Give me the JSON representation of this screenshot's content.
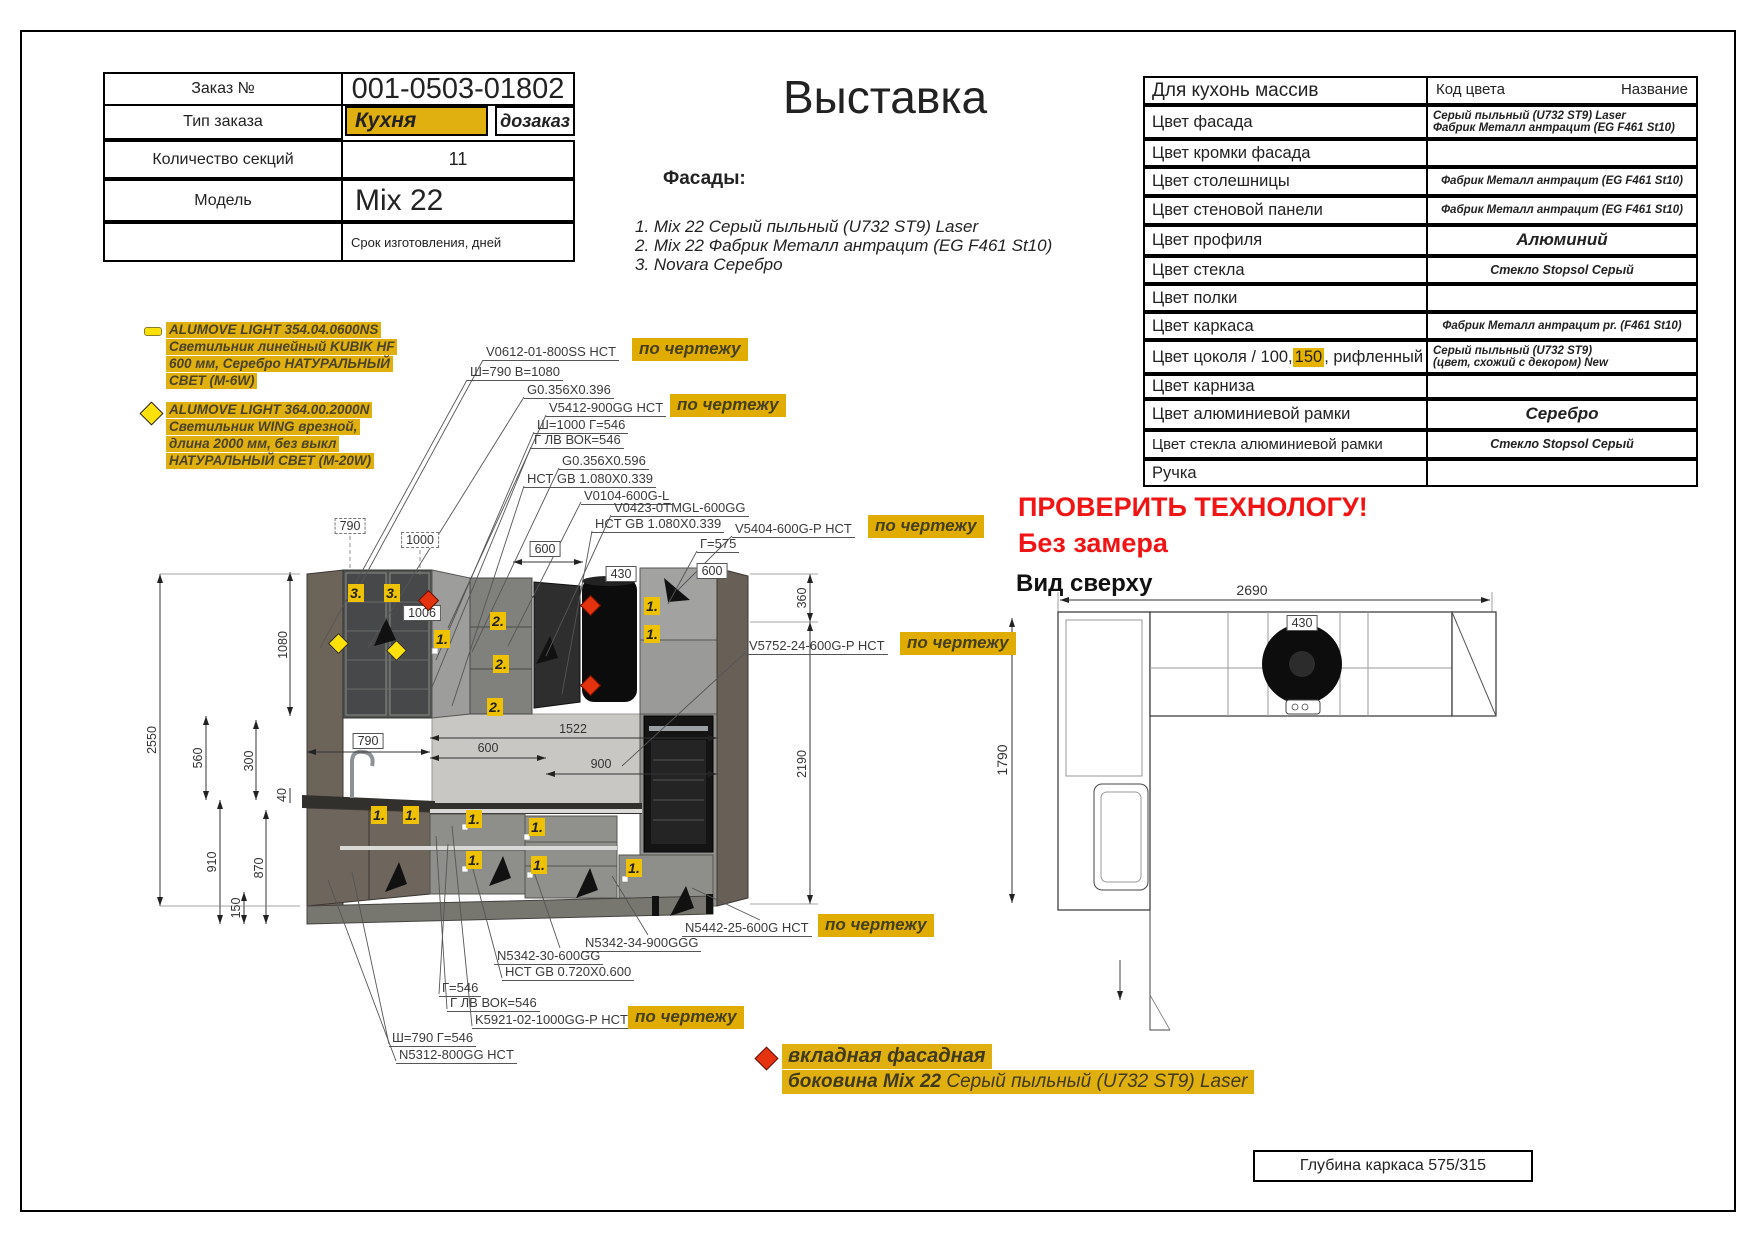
{
  "title": "Выставка",
  "order_table": {
    "r1_label": "Заказ №",
    "r1_value": "001-0503-01802",
    "r2_label": "Тип заказа",
    "r2_value_main": "Кухня",
    "r2_value_extra": "дозаказ",
    "r3_label": "Количество секций",
    "r3_value": "11",
    "r4_label": "Модель",
    "r4_value": "Mix 22",
    "r5_value": "Срок изготовления, дней"
  },
  "facades": {
    "heading": "Фасады:",
    "items": [
      "1. Mix 22 Серый пыльный (U732 ST9) Laser",
      "2. Mix 22 Фабрик Металл антрацит (EG F461 St10)",
      "3. Novara Серебро"
    ]
  },
  "color_table": {
    "header_left": "Для кухонь массив",
    "header_code": "Код цвета",
    "header_name": "Название",
    "rows": [
      {
        "label": "Цвет фасада",
        "value": "Серый пыльный (U732 ST9) Laser\nФабрик Металл антрацит (EG F461 St10)"
      },
      {
        "label": "Цвет кромки фасада",
        "value": ""
      },
      {
        "label": "Цвет столешницы",
        "value": "Фабрик Металл антрацит (EG F461 St10)"
      },
      {
        "label": "Цвет стеновой панели",
        "value": "Фабрик Металл антрацит (EG F461 St10)"
      },
      {
        "label": "Цвет профиля",
        "value": "Алюминий"
      },
      {
        "label": "Цвет стекла",
        "value": "Стекло Stopsol Серый"
      },
      {
        "label": "Цвет полки",
        "value": ""
      },
      {
        "label": "Цвет каркаса",
        "value": "Фабрик Металл антрацит pr. (F461 St10)"
      },
      {
        "label_pre": "Цвет цоколя / 100, ",
        "label_hl": "150",
        "label_post": ", рифленный",
        "value": "Серый пыльный (U732 ST9)\n(цвет, схожий с декором) New"
      },
      {
        "label": "Цвет карниза",
        "value": ""
      },
      {
        "label": "Цвет алюминиевой рамки",
        "value": "Серебро"
      },
      {
        "label": "Цвет стекла алюминиевой рамки",
        "value": "Стекло Stopsol Серый"
      },
      {
        "label": "Ручка",
        "value": ""
      }
    ]
  },
  "warnings": {
    "line1": "ПРОВЕРИТЬ ТЕХНОЛОГУ!",
    "line2": "Без замера"
  },
  "top_view": {
    "heading": "Вид сверху"
  },
  "lights": {
    "note1": {
      "l1": "ALUMOVE LIGHT 354.04.0600NS",
      "l2": "Светильник линейный KUBIK HF",
      "l3": "600 мм, Серебро НАТУРАЛЬНЫЙ",
      "l4": "СВЕТ (M-6W)"
    },
    "note2": {
      "l1": "ALUMOVE LIGHT 364.00.2000N",
      "l2": "Светильник WING врезной,",
      "l3": "длина 2000 мм, без выкл",
      "l4": "НАТУРАЛЬНЫЙ СВЕТ (M-20W)"
    }
  },
  "callouts": {
    "hl": "по чертежу",
    "items": [
      "V0612-01-800SS HCT",
      "Ш=790 B=1080",
      "G0.356X0.396",
      "V5412-900GG HCT",
      "Ш=1000 Г=546",
      "Г ЛВ ВОК=546",
      "G0.356X0.596",
      "НСТ GB 1.080X0.339",
      "V0104-600G-L",
      "V0423-0TMGL-600GG",
      "HCT GB 1.080X0.339",
      "V5404-600G-P HCT",
      "Г=575",
      "V5752-24-600G-P HCT",
      "N5442-25-600G HCT",
      "N5342-34-900GGG",
      "N5342-30-600GG",
      "HCT GB 0.720X0.600",
      "Г=546",
      "Г ЛВ ВОК=546",
      "K5921-02-1000GG-P HCT",
      "Ш=790 Г=546",
      "N5312-800GG HCT"
    ]
  },
  "dims": {
    "w2690": "2690",
    "d1790": "1790",
    "hood430": "430",
    "w790": "790",
    "w1000": "1000",
    "w1006": "1006",
    "w600": "600",
    "h360": "360",
    "h2190": "2190",
    "h2550": "2550",
    "h1080": "1080",
    "h560": "560",
    "h300": "300",
    "h40": "40",
    "h910": "910",
    "h870": "870",
    "h150": "150",
    "w1522": "1522",
    "w900": "900"
  },
  "markers": {
    "m1": "1.",
    "m2": "2.",
    "m3": "3."
  },
  "side_note": {
    "line1": "вкладная фасадная",
    "line2_bold": "боковина Mix 22",
    "line2_rest": " Серый пыльный (U732 ST9) Laser"
  },
  "footer": {
    "depth_note": "Глубина каркаса 575/315"
  }
}
